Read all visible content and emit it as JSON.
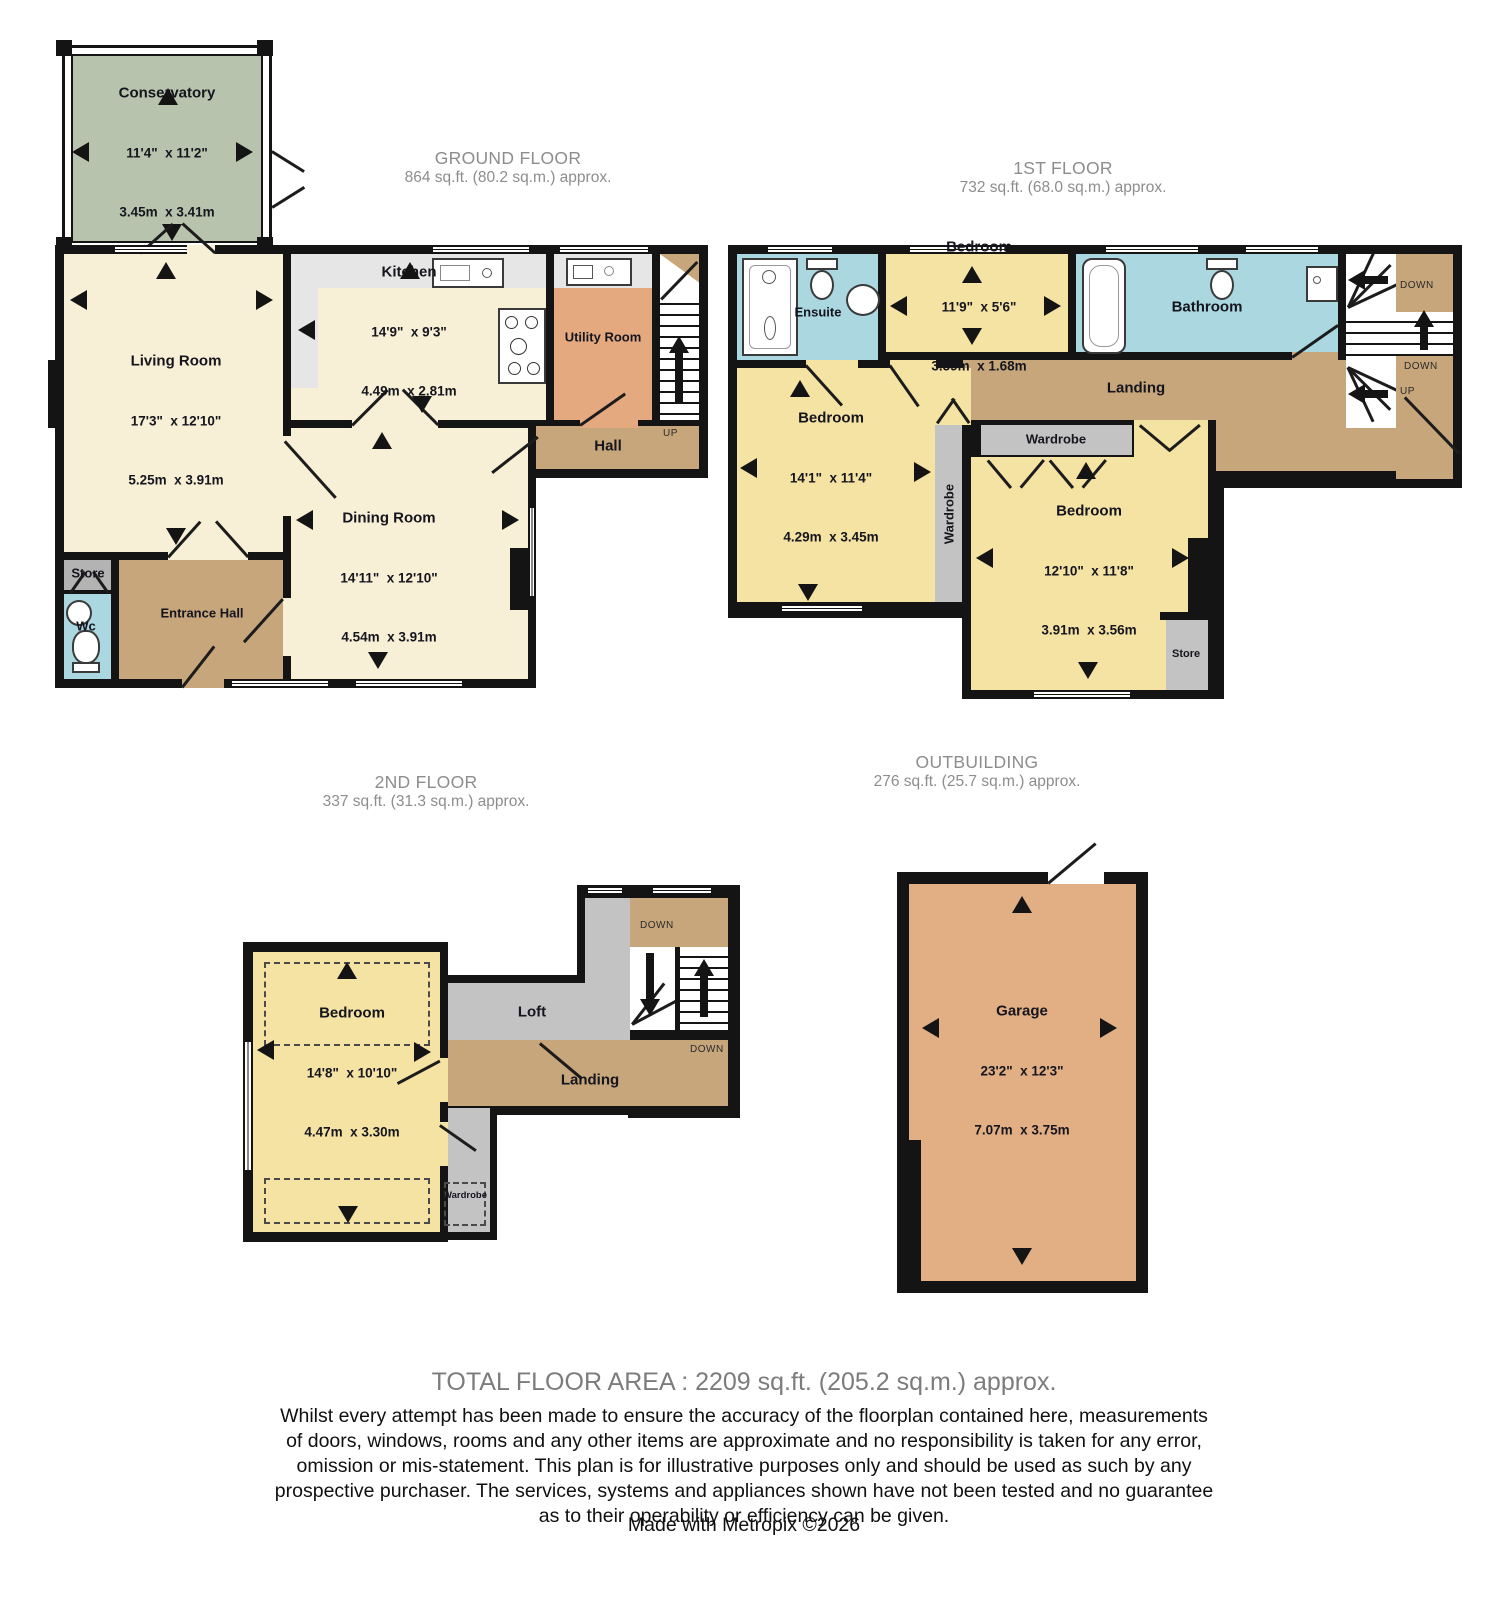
{
  "palette": {
    "wall": "#141414",
    "cream": "#f7f0d6",
    "yellow": "#f5e3a4",
    "blue": "#abd7e0",
    "green": "#b8c3ad",
    "brown": "#c7a67c",
    "orange": "#e4a97e",
    "garage": "#e2af85",
    "grey": "#c3c3c3",
    "storegrey": "#b3b3b3",
    "counter": "#e6e6e6",
    "header": "#8d8d8d"
  },
  "stair_labels": {
    "up": "UP",
    "down": "DOWN"
  },
  "ground_floor": {
    "title": "GROUND FLOOR",
    "area": "864 sq.ft. (80.2 sq.m.) approx.",
    "rooms": {
      "conservatory": {
        "name": "Conservatory",
        "imperial": "11'4\"  x 11'2\"",
        "metric": "3.45m  x 3.41m"
      },
      "living_room": {
        "name": "Living Room",
        "imperial": "17'3\"  x 12'10\"",
        "metric": "5.25m  x 3.91m"
      },
      "kitchen": {
        "name": "Kitchen",
        "imperial": "14'9\"  x 9'3\"",
        "metric": "4.49m  x 2.81m"
      },
      "utility_room": {
        "name": "Utility Room"
      },
      "hall": {
        "name": "Hall"
      },
      "dining_room": {
        "name": "Dining Room",
        "imperial": "14'11\"  x 12'10\"",
        "metric": "4.54m  x 3.91m"
      },
      "entrance_hall": {
        "name": "Entrance Hall"
      },
      "store": {
        "name": "Store"
      },
      "wc": {
        "name": "Wc"
      }
    }
  },
  "first_floor": {
    "title": "1ST FLOOR",
    "area": "732 sq.ft. (68.0 sq.m.) approx.",
    "rooms": {
      "ensuite": {
        "name": "Ensuite"
      },
      "bedroom_front": {
        "name": "Bedroom",
        "imperial": "11'9\"  x 5'6\"",
        "metric": "3.59m  x 1.68m"
      },
      "bathroom": {
        "name": "Bathroom"
      },
      "landing": {
        "name": "Landing"
      },
      "bedroom_left": {
        "name": "Bedroom",
        "imperial": "14'1\"  x 11'4\"",
        "metric": "4.29m  x 3.45m"
      },
      "bedroom_right": {
        "name": "Bedroom",
        "imperial": "12'10\"  x 11'8\"",
        "metric": "3.91m  x 3.56m"
      },
      "wardrobe": {
        "name": "Wardrobe"
      },
      "store": {
        "name": "Store"
      }
    }
  },
  "second_floor": {
    "title": "2ND FLOOR",
    "area": "337 sq.ft. (31.3 sq.m.) approx.",
    "rooms": {
      "bedroom": {
        "name": "Bedroom",
        "imperial": "14'8\"  x 10'10\"",
        "metric": "4.47m  x 3.30m"
      },
      "loft": {
        "name": "Loft"
      },
      "landing": {
        "name": "Landing"
      },
      "wardrobe": {
        "name": "Wardrobe"
      }
    }
  },
  "outbuilding": {
    "title": "OUTBUILDING",
    "area": "276 sq.ft. (25.7 sq.m.) approx.",
    "rooms": {
      "garage": {
        "name": "Garage",
        "imperial": "23'2\"  x 12'3\"",
        "metric": "7.07m  x 3.75m"
      }
    }
  },
  "footer": {
    "total": "TOTAL FLOOR AREA : 2209 sq.ft. (205.2 sq.m.) approx.",
    "disclaimer": "Whilst every attempt has been made to ensure the accuracy of the floorplan contained here, measurements\nof doors, windows, rooms and any other items are approximate and no responsibility is taken for any error,\nomission or mis-statement. This plan is for illustrative purposes only and should be used as such by any\nprospective purchaser. The services, systems and appliances shown have not been tested and no guarantee\nas to their operability or efficiency can be given.",
    "credit": "Made with Metropix ©2026"
  }
}
